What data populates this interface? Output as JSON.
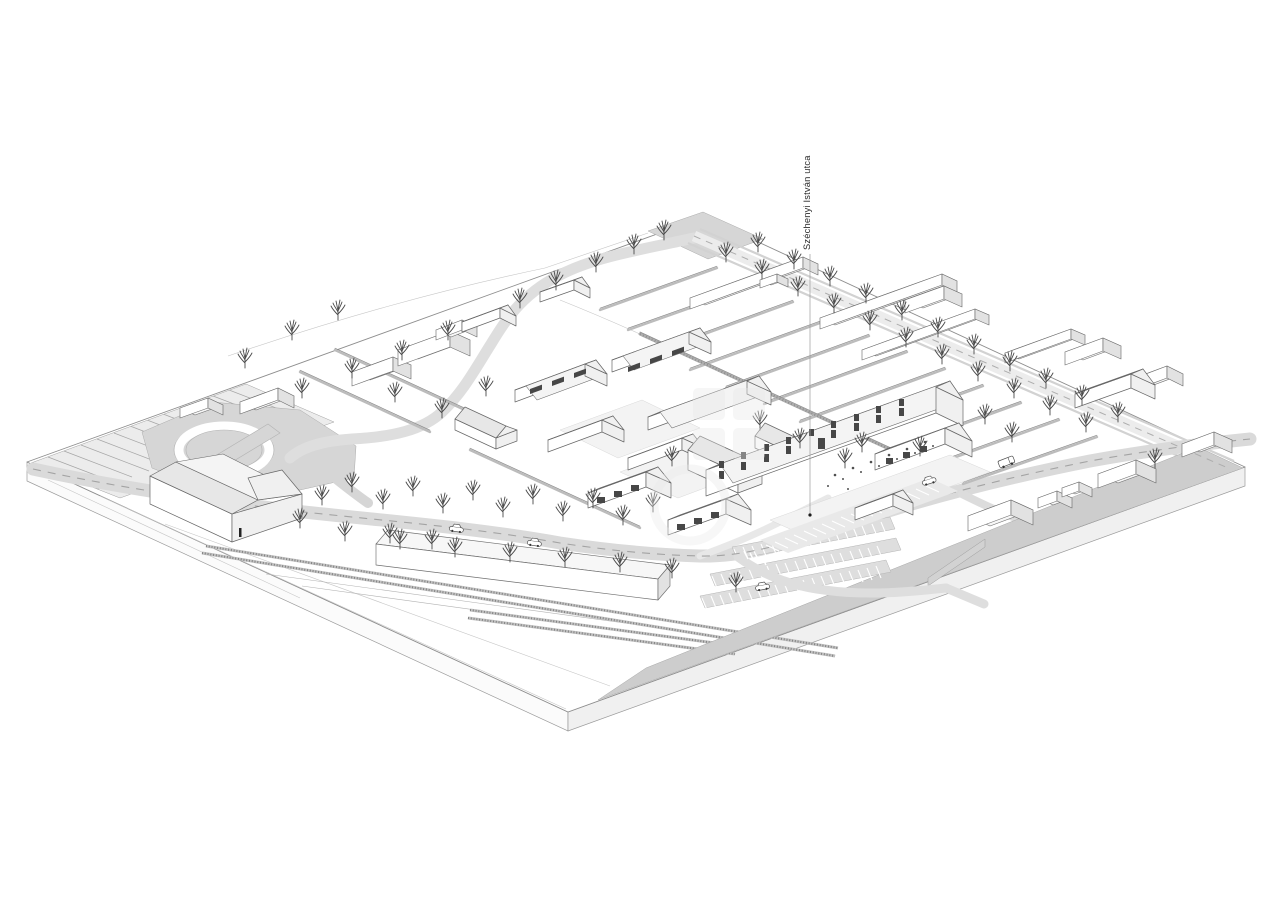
{
  "drawing": {
    "street_label": "Széchenyi István utca"
  },
  "palette": {
    "background": "#ffffff",
    "linework": "#676767",
    "road_fill": "#dadada",
    "road_dash": "#a3a3a3",
    "roof_fill": "#e7e7e7",
    "wall_fill": "#ffffff",
    "ground_shade": "#cdcdcd",
    "plaza_fill": "#d6d6d6",
    "tree_color": "#4a4a4a",
    "label_color": "#2b2b2b"
  }
}
